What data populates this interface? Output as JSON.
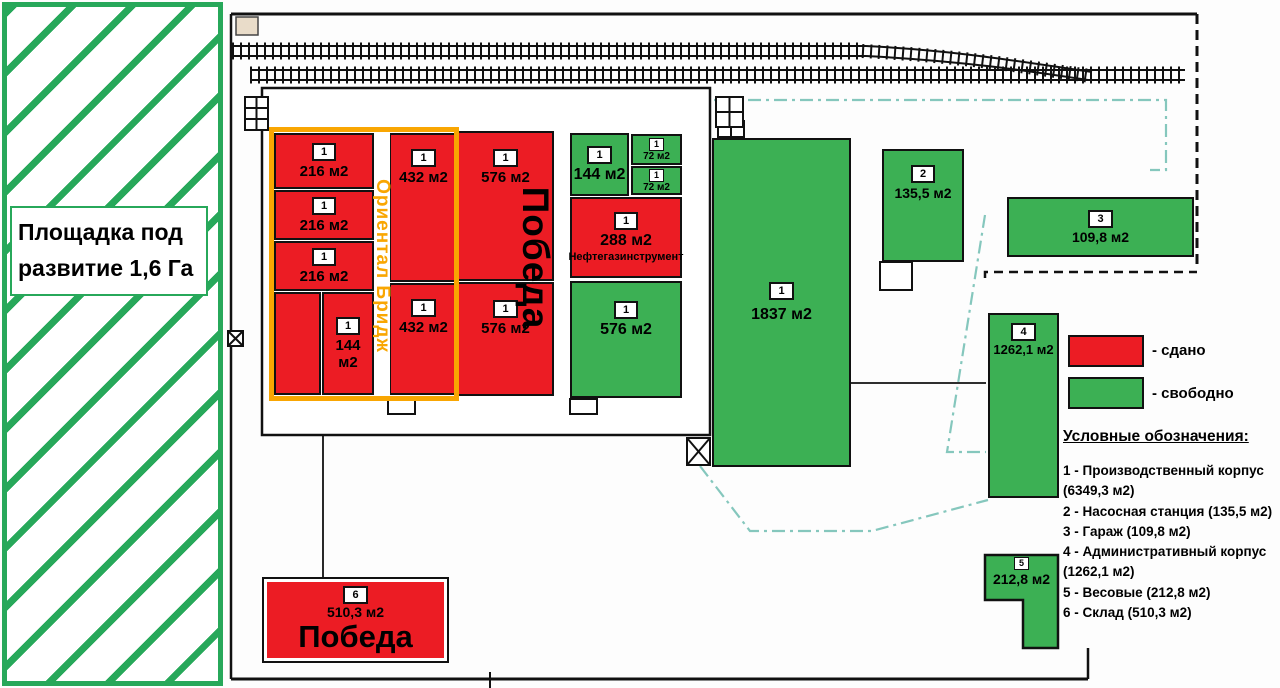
{
  "colors": {
    "leased_red": "#ec1c24",
    "free_green": "#3cb054",
    "orange": "#f9a602",
    "teal_dash": "#85c7bd",
    "hatch_green": "#27a85a"
  },
  "development_area": {
    "label": "Площадка под развитие 1,6 Га"
  },
  "tenant_labels": {
    "pobeda_vertical": "Победа",
    "oriental_bridge": "Ориентал Бридж"
  },
  "blocks": {
    "r216a": {
      "badge": "1",
      "area": "216 м2"
    },
    "r216b": {
      "badge": "1",
      "area": "216 м2"
    },
    "r216c": {
      "badge": "1",
      "area": "216 м2"
    },
    "r144": {
      "badge": "1",
      "area": "144 м2"
    },
    "r432a": {
      "badge": "1",
      "area": "432 м2"
    },
    "r432b": {
      "badge": "1",
      "area": "432 м2"
    },
    "r576a": {
      "badge": "1",
      "area": "576 м2"
    },
    "r576b": {
      "badge": "1",
      "area": "576 м2"
    },
    "g144": {
      "badge": "1",
      "area": "144 м2"
    },
    "g72a": {
      "badge": "1",
      "area": "72 м2"
    },
    "g72b": {
      "badge": "1",
      "area": "72 м2"
    },
    "r288": {
      "badge": "1",
      "area": "288 м2",
      "tenant": "Нефтегазинструмент"
    },
    "g576": {
      "badge": "1",
      "area": "576 м2"
    },
    "g1837": {
      "badge": "1",
      "area": "1837 м2"
    },
    "g135": {
      "badge": "2",
      "area": "135,5 м2"
    },
    "g109": {
      "badge": "3",
      "area": "109,8 м2"
    },
    "g1262": {
      "badge": "4",
      "area": "1262,1 м2"
    },
    "g212": {
      "badge": "5",
      "area": "212,8 м2"
    },
    "r510": {
      "badge": "6",
      "area": "510,3 м2",
      "tenant": "Победа"
    }
  },
  "legend": {
    "leased": "- сдано",
    "free": "- свободно"
  },
  "key": {
    "title": "Условные обозначения:",
    "items": [
      "1 - Производственный корпус (6349,3 м2)",
      "2 - Насосная станция (135,5 м2)",
      "3 - Гараж (109,8 м2)",
      "4 - Административный корпус (1262,1 м2)",
      "5 - Весовые (212,8 м2)",
      "6 - Склад (510,3 м2)"
    ]
  }
}
